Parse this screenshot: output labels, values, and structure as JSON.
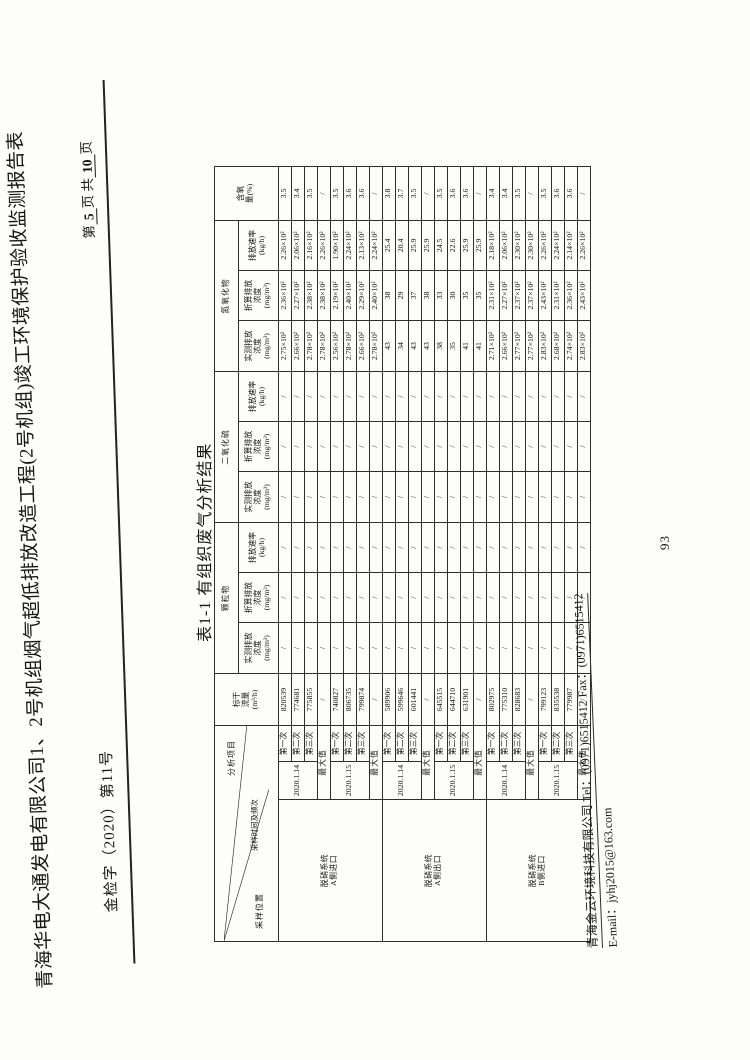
{
  "page": {
    "doc_number": "金检字（2020）第11号",
    "title": "青海华电大通发电有限公司1、2号机组烟气超低排放改造工程(2号机组)竣工环境保护验收监测报告表",
    "page_no": {
      "prefix": "第",
      "current": "5",
      "mid": "页  共",
      "total": "10",
      "suffix": "页"
    },
    "sheet_number": "93"
  },
  "table": {
    "caption": "表1-1 有组织废气分析结果",
    "corner": {
      "top_right": "分析项目",
      "middle": "采样时间及频次",
      "bottom_left": "采样位置"
    },
    "headers": {
      "flow": "标干\n流量\n(m³/h)",
      "particulate": "颗粒物",
      "so2": "二氧化硫",
      "nox": "氮氧化物",
      "oxygen": "含氧\n量(%)",
      "measured": "实测排放\n浓度\n(mg/m³)",
      "converted": "折算排放\n浓度\n(mg/m³)",
      "rate": "排放速率\n(kg/h)"
    },
    "rows": [
      {
        "loc": "脱硝系统\nA侧进口",
        "loc_span": 8,
        "date": "2020.1.14",
        "date_span": 3,
        "time": "第一次",
        "v": [
          "820539",
          "/",
          "/",
          "/",
          "/",
          "/",
          "/",
          "2.75×10²",
          "2.36×10²",
          "2.26×10²",
          "3.5"
        ]
      },
      {
        "time": "第二次",
        "v": [
          "774681",
          "/",
          "/",
          "/",
          "/",
          "/",
          "/",
          "2.66×10²",
          "2.27×10²",
          "2.06×10²",
          "3.4"
        ]
      },
      {
        "time": "第三次",
        "v": [
          "775855",
          "/",
          "/",
          "/",
          "/",
          "/",
          "/",
          "2.78×10²",
          "2.38×10²",
          "2.16×10²",
          "3.5"
        ]
      },
      {
        "max": "最大值",
        "v": [
          "/",
          "/",
          "/",
          "/",
          "/",
          "/",
          "/",
          "2.78×10²",
          "2.38×10²",
          "2.26×10²",
          "/"
        ]
      },
      {
        "date": "2020.1.15",
        "date_span": 3,
        "time": "第一次",
        "v": [
          "740827",
          "/",
          "/",
          "/",
          "/",
          "/",
          "/",
          "2.56×10²",
          "2.19×10²",
          "1.90×10²",
          "3.5"
        ]
      },
      {
        "time": "第二次",
        "v": [
          "806735",
          "/",
          "/",
          "/",
          "/",
          "/",
          "/",
          "2.78×10²",
          "2.40×10²",
          "2.24×10²",
          "3.6"
        ]
      },
      {
        "time": "第三次",
        "v": [
          "799874",
          "/",
          "/",
          "/",
          "/",
          "/",
          "/",
          "2.66×10²",
          "2.29×10²",
          "2.13×10²",
          "3.6"
        ]
      },
      {
        "max": "最大值",
        "v": [
          "/",
          "/",
          "/",
          "/",
          "/",
          "/",
          "/",
          "2.78×10²",
          "2.40×10²",
          "2.24×10²",
          "/"
        ]
      },
      {
        "loc": "脱硝系统\nA侧出口",
        "loc_span": 8,
        "date": "2020.1.14",
        "date_span": 3,
        "time": "第一次",
        "v": [
          "589906",
          "/",
          "/",
          "/",
          "/",
          "/",
          "/",
          "43",
          "38",
          "25.4",
          "3.8"
        ]
      },
      {
        "time": "第二次",
        "v": [
          "599646",
          "/",
          "/",
          "/",
          "/",
          "/",
          "/",
          "34",
          "29",
          "20.4",
          "3.7"
        ]
      },
      {
        "time": "第三次",
        "v": [
          "601441",
          "/",
          "/",
          "/",
          "/",
          "/",
          "/",
          "43",
          "37",
          "25.9",
          "3.5"
        ]
      },
      {
        "max": "最大值",
        "v": [
          "/",
          "/",
          "/",
          "/",
          "/",
          "/",
          "/",
          "43",
          "38",
          "25.9",
          "/"
        ]
      },
      {
        "date": "2020.1.15",
        "date_span": 3,
        "time": "第一次",
        "v": [
          "645515",
          "/",
          "/",
          "/",
          "/",
          "/",
          "/",
          "38",
          "33",
          "24.5",
          "3.5"
        ]
      },
      {
        "time": "第二次",
        "v": [
          "644710",
          "/",
          "/",
          "/",
          "/",
          "/",
          "/",
          "35",
          "30",
          "22.6",
          "3.6"
        ]
      },
      {
        "time": "第三次",
        "v": [
          "631901",
          "/",
          "/",
          "/",
          "/",
          "/",
          "/",
          "41",
          "35",
          "25.9",
          "3.6"
        ]
      },
      {
        "max": "最大值",
        "v": [
          "/",
          "/",
          "/",
          "/",
          "/",
          "/",
          "/",
          "41",
          "35",
          "25.9",
          "/"
        ]
      },
      {
        "loc": "脱硝系统\nB侧进口",
        "loc_span": 8,
        "date": "2020.1.14",
        "date_span": 3,
        "time": "第一次",
        "v": [
          "802975",
          "/",
          "/",
          "/",
          "/",
          "/",
          "/",
          "2.71×10²",
          "2.31×10²",
          "2.18×10²",
          "3.4"
        ]
      },
      {
        "time": "第二次",
        "v": [
          "775310",
          "/",
          "/",
          "/",
          "/",
          "/",
          "/",
          "2.66×10²",
          "2.27×10²",
          "2.06×10²",
          "3.4"
        ]
      },
      {
        "time": "第三次",
        "v": [
          "828683",
          "/",
          "/",
          "/",
          "/",
          "/",
          "/",
          "2.77×10²",
          "2.37×10²",
          "2.30×10²",
          "3.5"
        ]
      },
      {
        "max": "最大值",
        "v": [
          "/",
          "/",
          "/",
          "/",
          "/",
          "/",
          "/",
          "2.77×10²",
          "2.37×10²",
          "2.30×10²",
          "/"
        ]
      },
      {
        "date": "2020.1.15",
        "date_span": 3,
        "time": "第一次",
        "v": [
          "799123",
          "/",
          "/",
          "/",
          "/",
          "/",
          "/",
          "2.83×10²",
          "2.43×10²",
          "2.26×10²",
          "3.5"
        ]
      },
      {
        "time": "第二次",
        "v": [
          "835538",
          "/",
          "/",
          "/",
          "/",
          "/",
          "/",
          "2.68×10²",
          "2.31×10²",
          "2.24×10²",
          "3.6"
        ]
      },
      {
        "time": "第三次",
        "v": [
          "779987",
          "/",
          "/",
          "/",
          "/",
          "/",
          "/",
          "2.74×10²",
          "2.36×10²",
          "2.14×10²",
          "3.6"
        ]
      },
      {
        "max": "最大值",
        "v": [
          "/",
          "/",
          "/",
          "/",
          "/",
          "/",
          "/",
          "2.83×10²",
          "2.43×10²",
          "2.26×10²",
          "/"
        ]
      }
    ]
  },
  "footer": {
    "line1": "青海金云环境科技有限公司 Tel：(0971)6515412    Fax：(0971)6515412",
    "line2": "E-mail：jyhj2015@163.com"
  }
}
